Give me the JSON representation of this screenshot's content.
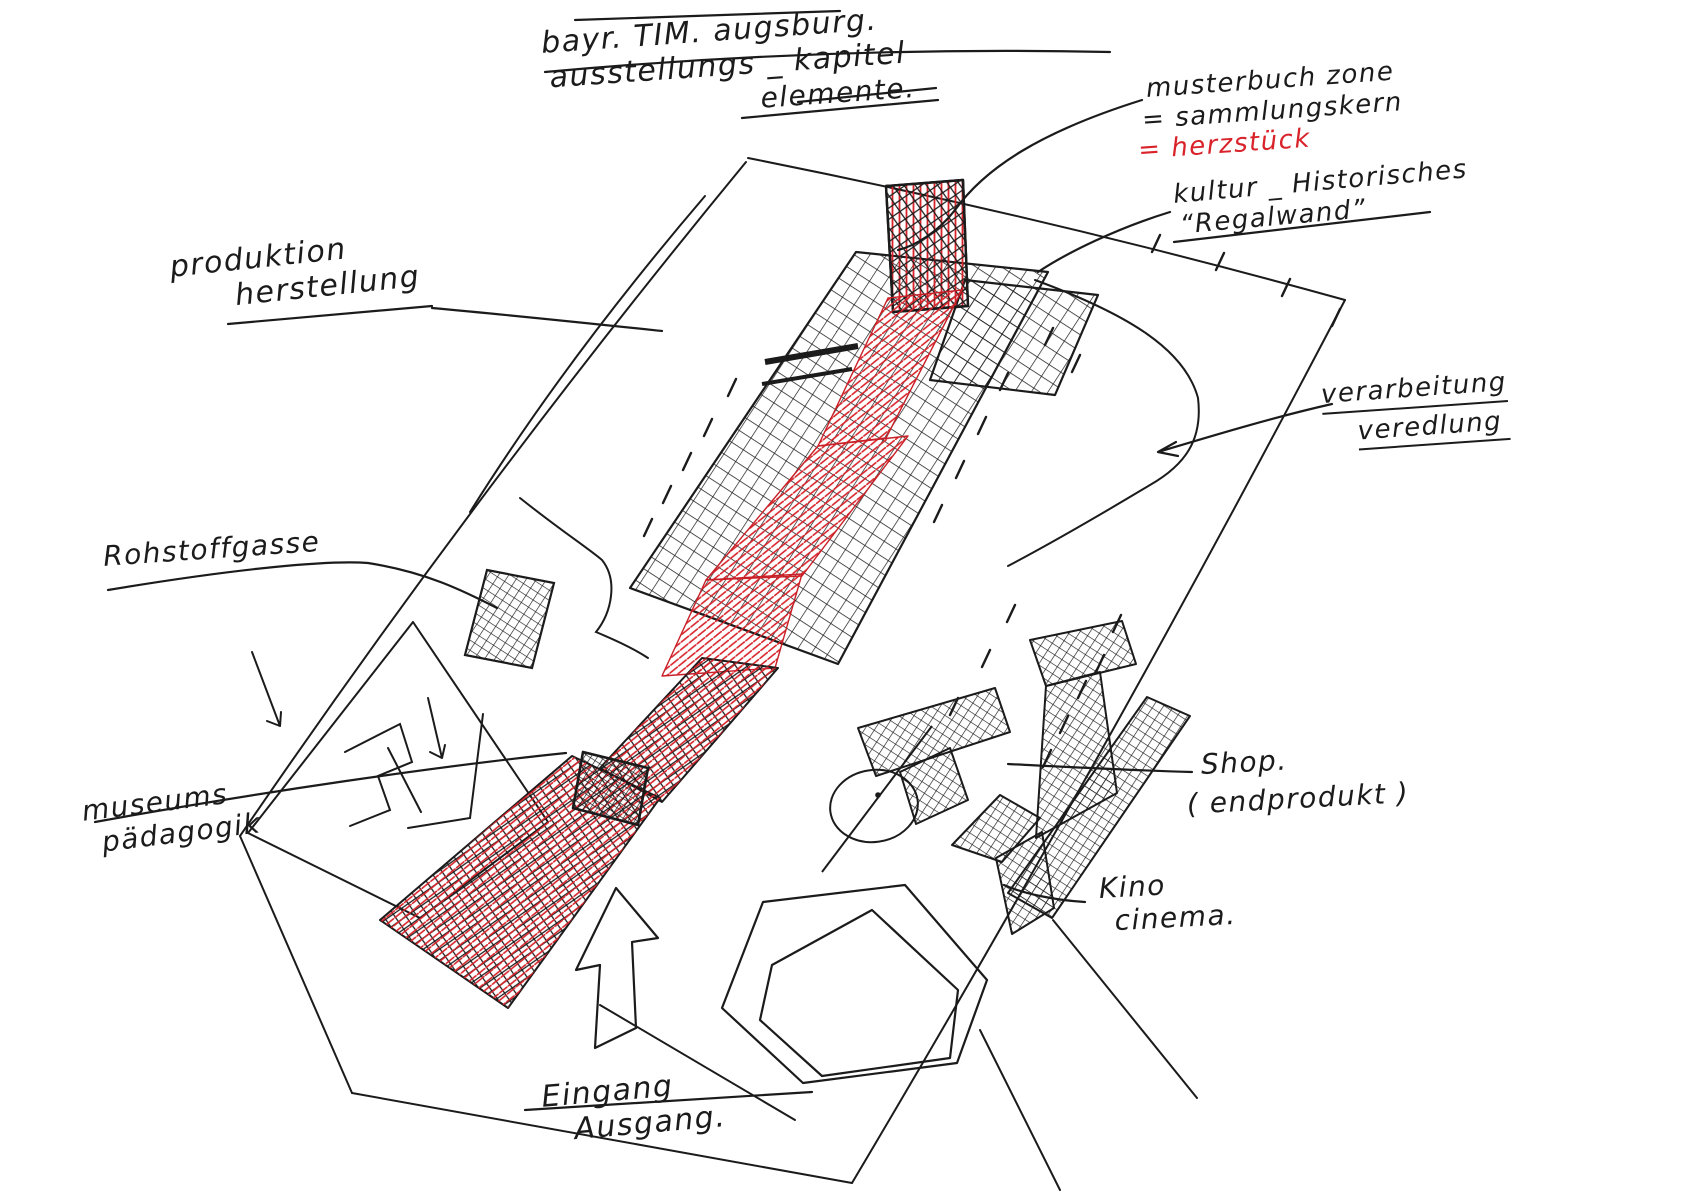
{
  "sketch_title": {
    "line1": "bayr. TIM. augsburg.",
    "line2": "ausstellungs _ kapitel",
    "line3": "elemente."
  },
  "annotations": {
    "musterbuch": {
      "line1": "musterbuch zone",
      "line2": "= sammlungskern",
      "line3": "= herzstück"
    },
    "kultur": {
      "line1": "kultur _ Historisches",
      "line2": "“Regalwand”"
    },
    "produktion": {
      "line1": "produktion",
      "line2": "herstellung"
    },
    "verarbeitung": {
      "line1": "verarbeitung",
      "line2": "veredlung"
    },
    "rohstoffgasse": {
      "line1": "Rohstoffgasse"
    },
    "museumspaedagogik": {
      "line1": "museums",
      "line2": "pädagogik"
    },
    "shop": {
      "line1": "Shop.",
      "line2": "( endprodukt )"
    },
    "kino": {
      "line1": "Kino",
      "line2": "cinema."
    },
    "eingang": {
      "line1": "Eingang",
      "line2": "Ausgang."
    }
  },
  "colors": {
    "ink": "#1b1b1b",
    "red_marker": "#d8232a",
    "paper": "#ffffff"
  }
}
